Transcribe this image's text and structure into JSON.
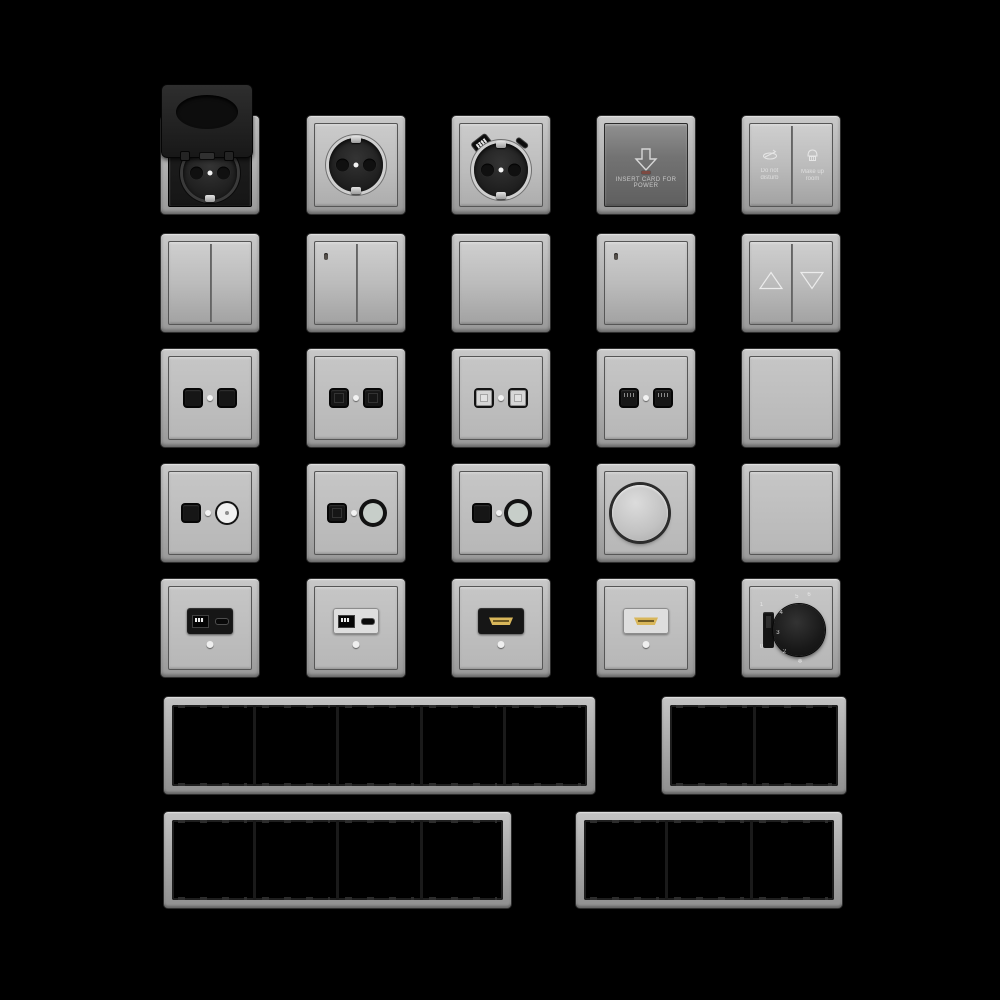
{
  "canvas": {
    "background": "#000000",
    "width": 1000,
    "height": 1000
  },
  "palette": {
    "plate_light": "#b9b9b9",
    "plate_face": "#c4c4c4",
    "plate_dark_face": "#6e6e6e",
    "insert_black": "#161616",
    "hdmi_gold": "#d8b65a",
    "led_red": "#7d4a42",
    "dot_white": "#f2f2f2",
    "frame_interior": "#000000"
  },
  "labels": {
    "key_card": "INSERT CARD FOR POWER",
    "dnd_line1": "Do not",
    "dnd_line2": "disturb",
    "mur_line1": "Make up",
    "mur_line2": "room"
  },
  "thermostat": {
    "n2": "2",
    "n3": "3",
    "n4": "4",
    "n5": "5",
    "n6": "6",
    "snow": "❄",
    "slider_on": "1",
    "slider_off": "0"
  },
  "items": [
    {
      "row": 1,
      "col": 1,
      "name": "socket-flip-cover",
      "type": "schuko socket with open hinged black cover"
    },
    {
      "row": 1,
      "col": 2,
      "name": "socket-schuko",
      "type": "schuko socket"
    },
    {
      "row": 1,
      "col": 3,
      "name": "socket-schuko-usb",
      "type": "schuko socket with USB-A and USB-C ports"
    },
    {
      "row": 1,
      "col": 4,
      "name": "key-card-switch",
      "type": "hotel key card power switch with down arrow and LED"
    },
    {
      "row": 1,
      "col": 5,
      "name": "service-indicator-panel",
      "type": "do-not-disturb / make-up-room button panel"
    },
    {
      "row": 2,
      "col": 1,
      "name": "switch-2gang",
      "type": "double rocker switch"
    },
    {
      "row": 2,
      "col": 2,
      "name": "switch-2gang-led",
      "type": "double rocker switch with indicator"
    },
    {
      "row": 2,
      "col": 3,
      "name": "switch-1gang",
      "type": "single rocker switch"
    },
    {
      "row": 2,
      "col": 4,
      "name": "switch-1gang-led",
      "type": "single rocker switch with indicator"
    },
    {
      "row": 2,
      "col": 5,
      "name": "blind-switch",
      "type": "shutter switch with up and down triangles"
    },
    {
      "row": 3,
      "col": 1,
      "name": "data-outlet-2port-a",
      "type": "double data outlet, black jacks"
    },
    {
      "row": 3,
      "col": 2,
      "name": "data-outlet-2port-b",
      "type": "double data outlet, black jacks"
    },
    {
      "row": 3,
      "col": 3,
      "name": "data-outlet-2port-shuttered",
      "type": "double outlet with light shuttered jacks"
    },
    {
      "row": 3,
      "col": 4,
      "name": "data-outlet-2port-rj45",
      "type": "double RJ45 outlet with visible pins"
    },
    {
      "row": 3,
      "col": 5,
      "name": "switch-1gang-flat",
      "type": "single flat rocker switch"
    },
    {
      "row": 4,
      "col": 1,
      "name": "tv-data-outlet-a",
      "type": "combo outlet, square jack + white coax"
    },
    {
      "row": 4,
      "col": 2,
      "name": "tv-data-outlet-b",
      "type": "combo outlet, square jack + ringed coax"
    },
    {
      "row": 4,
      "col": 3,
      "name": "tv-data-outlet-c",
      "type": "combo outlet, square jack + ringed coax"
    },
    {
      "row": 4,
      "col": 4,
      "name": "rotary-dimmer",
      "type": "rotary dimmer knob"
    },
    {
      "row": 4,
      "col": 5,
      "name": "blank-plate",
      "type": "blind cover plate"
    },
    {
      "row": 5,
      "col": 1,
      "name": "usb-outlet-black",
      "type": "USB-A + USB-C outlet, black insert"
    },
    {
      "row": 5,
      "col": 2,
      "name": "usb-outlet-light",
      "type": "USB-A + USB-C outlet, light insert"
    },
    {
      "row": 5,
      "col": 3,
      "name": "hdmi-outlet-black",
      "type": "HDMI outlet, black insert"
    },
    {
      "row": 5,
      "col": 4,
      "name": "hdmi-outlet-light",
      "type": "HDMI outlet, light insert"
    },
    {
      "row": 5,
      "col": 5,
      "name": "thermostat",
      "type": "thermostat with black dial, scale and on/off slider"
    }
  ],
  "frames": [
    {
      "name": "frame-5-gang",
      "gangs": 5
    },
    {
      "name": "frame-2-gang",
      "gangs": 2
    },
    {
      "name": "frame-4-gang",
      "gangs": 4
    },
    {
      "name": "frame-3-gang",
      "gangs": 3
    }
  ]
}
